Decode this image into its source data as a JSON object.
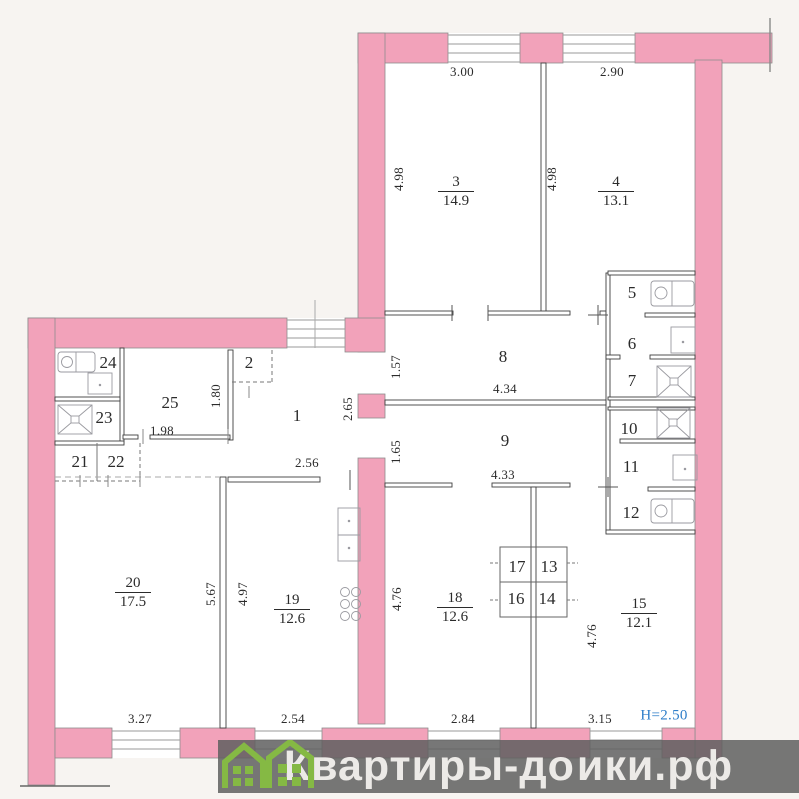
{
  "title": "apartment-floor-plan",
  "plan": {
    "wall_color": "#f2a2ba",
    "background_color": "#f7f4f1",
    "line_color": "#3f3f3f",
    "room_area_labels": [
      {
        "name": "room-3-label",
        "number": "3",
        "area": "14.9",
        "x": 456,
        "y": 192
      },
      {
        "name": "room-4-label",
        "number": "4",
        "area": "13.1",
        "x": 616,
        "y": 192
      },
      {
        "name": "room-15-label",
        "number": "15",
        "area": "12.1",
        "x": 639,
        "y": 614
      },
      {
        "name": "room-18-label",
        "number": "18",
        "area": "12.6",
        "x": 455,
        "y": 608
      },
      {
        "name": "room-19-label",
        "number": "19",
        "area": "12.6",
        "x": 292,
        "y": 610
      },
      {
        "name": "room-20-label",
        "number": "20",
        "area": "17.5",
        "x": 133,
        "y": 593
      }
    ],
    "room_number_labels": [
      {
        "name": "room-1-label",
        "text": "1",
        "x": 297,
        "y": 416
      },
      {
        "name": "room-2-label",
        "text": "2",
        "x": 249,
        "y": 363
      },
      {
        "name": "room-5-label",
        "text": "5",
        "x": 632,
        "y": 293
      },
      {
        "name": "room-6-label",
        "text": "6",
        "x": 632,
        "y": 344
      },
      {
        "name": "room-7-label",
        "text": "7",
        "x": 632,
        "y": 381
      },
      {
        "name": "room-8-label",
        "text": "8",
        "x": 503,
        "y": 357
      },
      {
        "name": "room-9-label",
        "text": "9",
        "x": 505,
        "y": 441
      },
      {
        "name": "room-10-label",
        "text": "10",
        "x": 629,
        "y": 429
      },
      {
        "name": "room-11-label",
        "text": "11",
        "x": 631,
        "y": 467
      },
      {
        "name": "room-12-label",
        "text": "12",
        "x": 631,
        "y": 513
      },
      {
        "name": "room-13-label",
        "text": "13",
        "x": 549,
        "y": 567
      },
      {
        "name": "room-14-label",
        "text": "14",
        "x": 547,
        "y": 599
      },
      {
        "name": "room-16-label",
        "text": "16",
        "x": 516,
        "y": 599
      },
      {
        "name": "room-17-label",
        "text": "17",
        "x": 517,
        "y": 567
      },
      {
        "name": "room-21-label",
        "text": "21",
        "x": 80,
        "y": 462
      },
      {
        "name": "room-22-label",
        "text": "22",
        "x": 116,
        "y": 462
      },
      {
        "name": "room-23-label",
        "text": "23",
        "x": 104,
        "y": 418
      },
      {
        "name": "room-24-label",
        "text": "24",
        "x": 108,
        "y": 363
      },
      {
        "name": "room-25-label",
        "text": "25",
        "x": 170,
        "y": 403
      }
    ],
    "dimension_labels": [
      {
        "name": "dim-room3-width",
        "text": "3.00",
        "x": 462,
        "y": 72
      },
      {
        "name": "dim-room4-width",
        "text": "2.90",
        "x": 612,
        "y": 72
      },
      {
        "name": "dim-room3-height",
        "text": "4.98",
        "x": 399,
        "y": 179,
        "rot": true
      },
      {
        "name": "dim-room4-height",
        "text": "4.98",
        "x": 552,
        "y": 179,
        "rot": true
      },
      {
        "name": "dim-corridor8-left",
        "text": "1.57",
        "x": 396,
        "y": 367,
        "rot": true
      },
      {
        "name": "dim-corridor8-length",
        "text": "4.34",
        "x": 505,
        "y": 389
      },
      {
        "name": "dim-hall1-height",
        "text": "2.65",
        "x": 348,
        "y": 409,
        "rot": true
      },
      {
        "name": "dim-corridor9-left",
        "text": "1.65",
        "x": 396,
        "y": 452,
        "rot": true
      },
      {
        "name": "dim-corridor9-length",
        "text": "4.33",
        "x": 503,
        "y": 475
      },
      {
        "name": "dim-hall1-left",
        "text": "1.80",
        "x": 216,
        "y": 396,
        "rot": true
      },
      {
        "name": "dim-room25-width",
        "text": "1.98",
        "x": 162,
        "y": 431
      },
      {
        "name": "dim-hall1-width",
        "text": "2.56",
        "x": 307,
        "y": 463
      },
      {
        "name": "dim-room20-height",
        "text": "5.67",
        "x": 211,
        "y": 594,
        "rot": true
      },
      {
        "name": "dim-room19-height",
        "text": "4.97",
        "x": 243,
        "y": 594,
        "rot": true
      },
      {
        "name": "dim-room18-height",
        "text": "4.76",
        "x": 397,
        "y": 599,
        "rot": true
      },
      {
        "name": "dim-room15-height",
        "text": "4.76",
        "x": 592,
        "y": 636,
        "rot": true
      },
      {
        "name": "dim-room20-width",
        "text": "3.27",
        "x": 140,
        "y": 719
      },
      {
        "name": "dim-room19-width",
        "text": "2.54",
        "x": 293,
        "y": 719
      },
      {
        "name": "dim-room18-width",
        "text": "2.84",
        "x": 463,
        "y": 719
      },
      {
        "name": "dim-room15-width",
        "text": "3.15",
        "x": 600,
        "y": 719
      },
      {
        "name": "ceiling-height-note",
        "text": "H=2.50",
        "x": 664,
        "y": 716,
        "color": "#2e7ec9",
        "size": 15
      }
    ],
    "fixtures": [
      {
        "room": "24",
        "icon": "bathtub-icon"
      },
      {
        "room": "24",
        "icon": "sink-icon"
      },
      {
        "room": "23",
        "icon": "shower-icon"
      },
      {
        "room": "5",
        "icon": "bathtub-icon"
      },
      {
        "room": "6",
        "icon": "sink-icon"
      },
      {
        "room": "7",
        "icon": "shower-icon"
      },
      {
        "room": "10",
        "icon": "shower-icon"
      },
      {
        "room": "11",
        "icon": "sink-icon"
      },
      {
        "room": "12",
        "icon": "bathtub-icon"
      },
      {
        "room": "19",
        "icon": "kitchen-sink-icon"
      },
      {
        "room": "19",
        "icon": "stove-icon"
      }
    ]
  },
  "watermark": {
    "part1": "Квартиры-до",
    "part2": "ики.рф",
    "icon": "green-houses-icon",
    "band_color": "rgba(95,95,95,0.85)",
    "text_color": "#eceae7",
    "house_color": "#85b944"
  }
}
